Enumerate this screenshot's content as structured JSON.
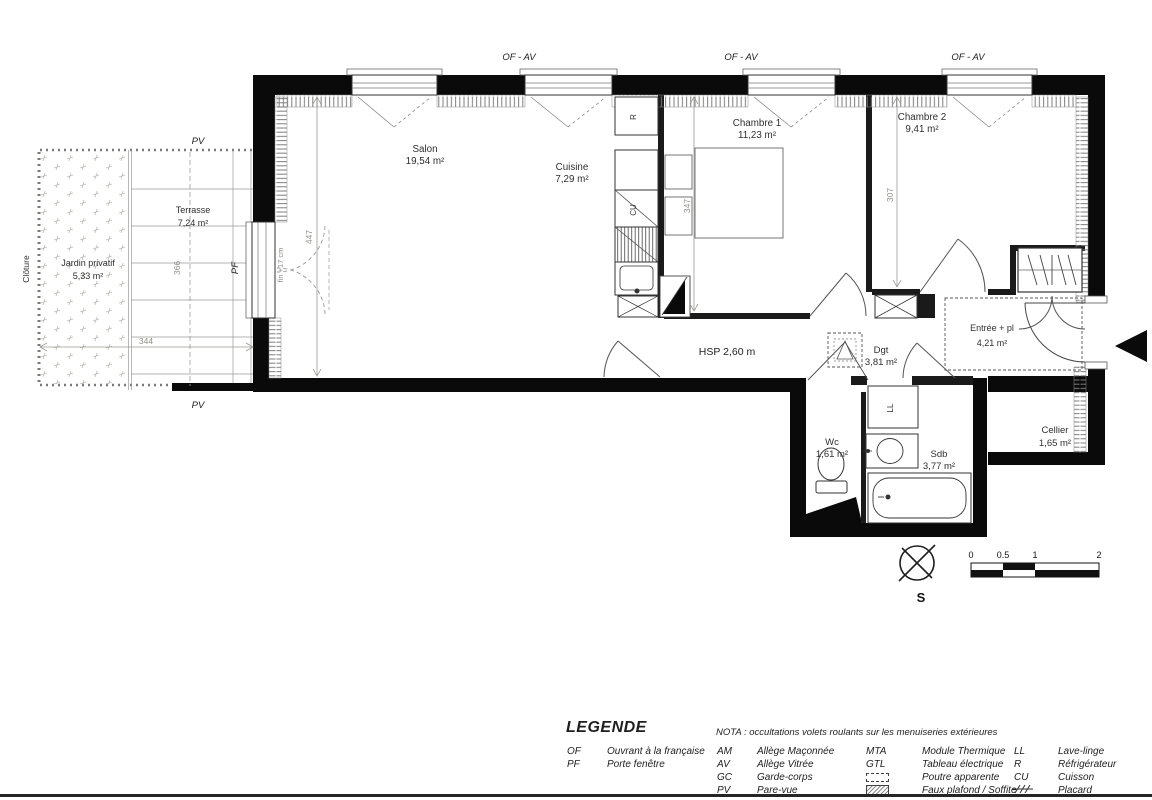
{
  "plan": {
    "of_av": "OF - AV",
    "pv_top": "PV",
    "pv_bottom": "PV",
    "pf": "PF",
    "cloture": "Clôture",
    "fin_note": "fin +17 cm",
    "hsp": "HSP 2,60 m",
    "rooms": [
      {
        "name": "Salon",
        "area": "19,54 m²"
      },
      {
        "name": "Cuisine",
        "area": "7,29 m²"
      },
      {
        "name": "Chambre 1",
        "area": "11,23 m²"
      },
      {
        "name": "Chambre 2",
        "area": "9,41 m²"
      },
      {
        "name": "Terrasse",
        "area": "7,24 m²"
      },
      {
        "name": "Jardin privatif",
        "area": "5,33 m²"
      },
      {
        "name": "Entrée + pl",
        "area": "4,21 m²"
      },
      {
        "name": "Dgt",
        "area": "3,81 m²"
      },
      {
        "name": "Wc",
        "area": "1,61 m²"
      },
      {
        "name": "Sdb",
        "area": "3,77 m²"
      },
      {
        "name": "Cellier",
        "area": "1,65 m²"
      }
    ],
    "dims": {
      "d447": "447",
      "d347": "347",
      "d307": "307",
      "d366": "366",
      "d344": "344"
    },
    "appliances": {
      "fridge": "R",
      "hob": "CU",
      "washer": "LL"
    },
    "compass_south": "S",
    "scalebar": {
      "t0": "0",
      "t05": "0.5",
      "t1": "1",
      "t2": "2"
    }
  },
  "legend": {
    "title": "LEGENDE",
    "nota": "NOTA : occultations volets roulants sur les menuiseries extérieures",
    "col1": [
      {
        "k": "OF",
        "v": "Ouvrant à la française"
      },
      {
        "k": "PF",
        "v": "Porte fenêtre"
      }
    ],
    "col2": [
      {
        "k": "AM",
        "v": "Allège Maçonnée"
      },
      {
        "k": "AV",
        "v": "Allège Vitrée"
      },
      {
        "k": "GC",
        "v": "Garde-corps"
      },
      {
        "k": "PV",
        "v": "Pare-vue"
      }
    ],
    "col3": [
      {
        "k": "MTA",
        "v": "Module Thermique"
      },
      {
        "k": "GTL",
        "v": "Tableau électrique"
      },
      {
        "k": "",
        "v": "Poutre apparente"
      },
      {
        "k": "",
        "v": "Faux plafond / Soffite"
      }
    ],
    "col4": [
      {
        "k": "LL",
        "v": "Lave-linge"
      },
      {
        "k": "R",
        "v": "Réfrigérateur"
      },
      {
        "k": "CU",
        "v": "Cuisson"
      },
      {
        "k": "",
        "v": "Placard"
      }
    ]
  }
}
